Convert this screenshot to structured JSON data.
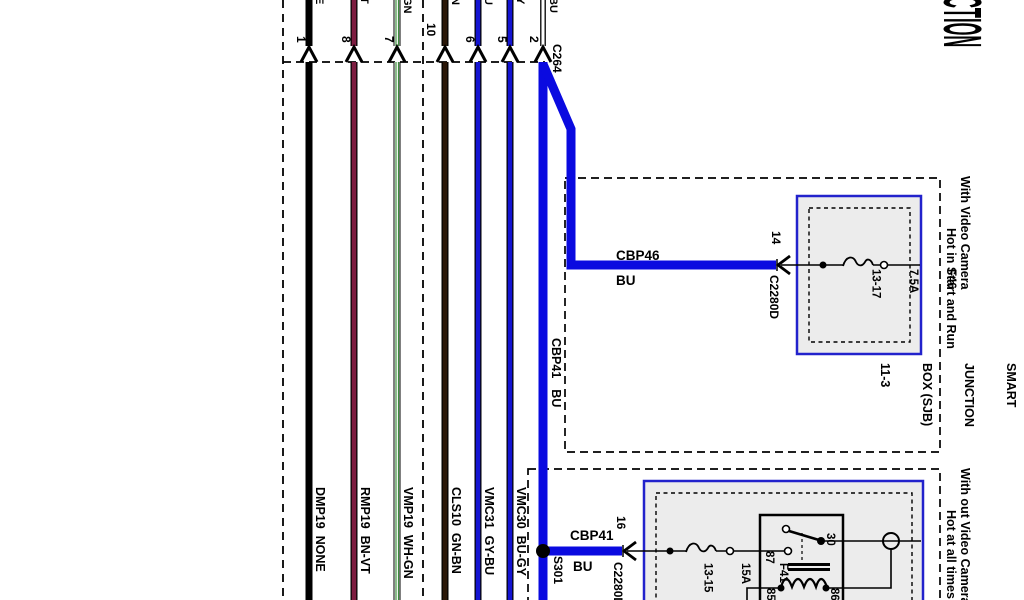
{
  "diagram": {
    "title_fragment": "CTION",
    "connector": {
      "name": "C264"
    },
    "wires": [
      {
        "pin": "1",
        "label": "DMP19  NONE",
        "top_fragment": "E"
      },
      {
        "pin": "8",
        "label": "RMP19  BN-VT",
        "top_fragment": "T"
      },
      {
        "pin": "7",
        "label": "VMP19  WH-GN",
        "top_fragment": "GN"
      },
      {
        "pin": "10",
        "label": "CLS10  GN-BN",
        "top_fragment": "N"
      },
      {
        "pin": "6",
        "label": "VMC31  GY-BU",
        "top_fragment": "U"
      },
      {
        "pin": "5",
        "label": "VMC30  BU-GY",
        "top_fragment": "Y"
      },
      {
        "pin": "2",
        "label": "",
        "top_fragment": "BU"
      }
    ],
    "branch": {
      "cbp46": {
        "circuit": "CBP46",
        "color": "BU",
        "pin": "14",
        "connector": "C2280D"
      },
      "cbp41": {
        "circuit": "CBP41",
        "color": "BU",
        "pin": "16",
        "connector": "C2280D",
        "splice": "S301"
      }
    },
    "box_with_camera": {
      "conditions": [
        "With Video Camera",
        "Hot in Start and Run"
      ],
      "fuse_lines": [
        "F46",
        "7.5A",
        "13-17"
      ],
      "component_lines": [
        "SMART",
        "JUNCTION",
        "BOX (SJB)",
        "11-3"
      ]
    },
    "box_without_camera": {
      "conditions": [
        "With out Video Camera",
        "Hot at all times"
      ],
      "fuse_lines": [
        "F41",
        "15A",
        "13-15"
      ],
      "relay_pins": {
        "p30": "30",
        "p87": "87",
        "p85": "85",
        "p86": "86"
      }
    },
    "colors": {
      "wire_blue": "#1414d2",
      "thick_blue": "#0a0ae0",
      "wire_brown_violet": "#7d1c40",
      "wire_green_brown": "#2a1708",
      "wire_stripe_green": "#3f8f3f",
      "box_border_blue": "#2222cc",
      "box_fill_gray": "#ececec"
    }
  }
}
